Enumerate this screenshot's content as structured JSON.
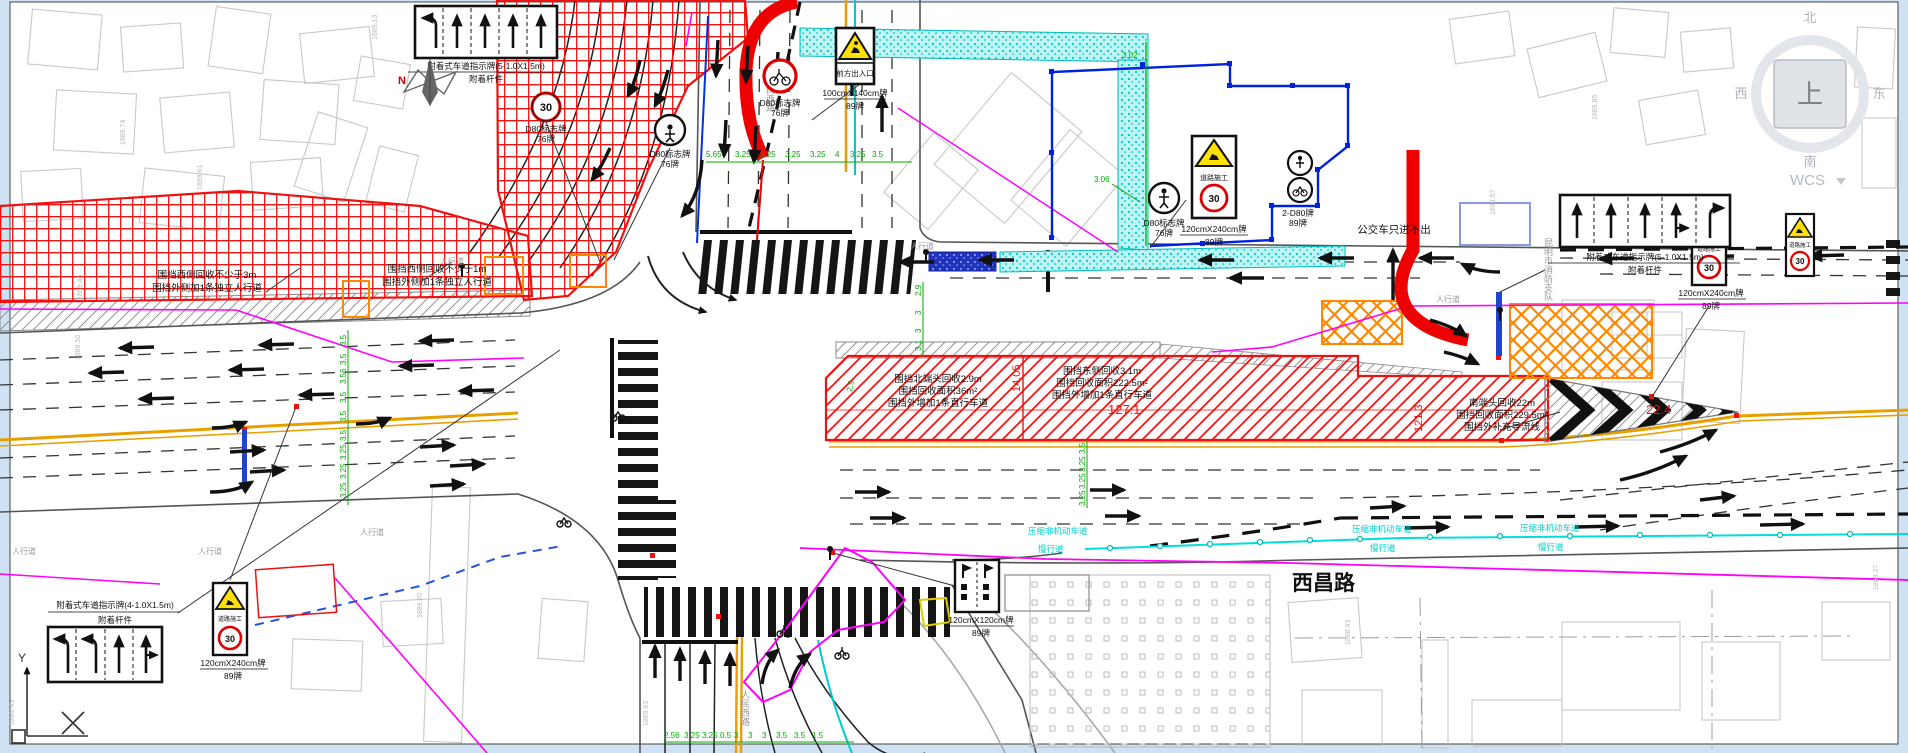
{
  "viewcube": {
    "up": "上",
    "north": "北",
    "south": "南",
    "west": "西",
    "east": "东",
    "wcs": "WCS"
  },
  "roads": {
    "renmin": "人民西路",
    "xichang": "西昌路",
    "fire": "昆明市消防支队",
    "sidewalk": "人行道",
    "bus_note": "公交车只进不出"
  },
  "signs": {
    "speed": "30",
    "work_plate": "道路施工",
    "entrance_plate": "前方出入口",
    "d80": "D80标志牌",
    "d80_count": "76牌",
    "d80x2": "2-D80牌",
    "c89": "89牌",
    "s100": "100cmX140cm牌",
    "s240": "120cmX240cm牌",
    "s120": "120cmX120cm牌",
    "north": "N"
  },
  "boards": {
    "b5": "附着式车道指示牌(5-1.0X1.5m)",
    "b4": "附着式车道指示牌(4-1.0X1.5m)",
    "pole": "附着杆件"
  },
  "zones": {
    "west_a1": "围挡西侧回收不少于3m",
    "west_a2": "围挡外侧加1条独立人行道",
    "west_b1": "围挡西侧回收不少于1m",
    "west_b2": "围挡外侧加1条独立人行道",
    "north1": "围挡北端头回收2.9m",
    "north2": "围挡回收面积36m²",
    "north3": "围挡外增加1条直行车道",
    "east1": "围挡东侧回收3.1m",
    "east2": "围挡回收面积222.5m²",
    "east3": "围挡外增加1条直行车道",
    "south1": "南端头回收22m",
    "south2": "围挡回收面积229.5m²",
    "south3": "围挡外补充导流线"
  },
  "bike": {
    "a": "压缩非机动车道",
    "b": "慢行道"
  },
  "dims": {
    "north_row": [
      "5.65",
      "3.25",
      "3.25",
      "3.25",
      "3.25",
      "4",
      "3.25",
      "3.5"
    ],
    "west_col": [
      "3.5",
      "3.5",
      "3.56",
      "3.5",
      "3.5",
      "3.5",
      "3.25",
      "3.25",
      "3.25"
    ],
    "mid_col": [
      "2.9",
      "3",
      "3",
      "3.1"
    ],
    "east_col": [
      "3.5",
      "3.25",
      "3.25",
      "3.25"
    ],
    "south_row": [
      "2.56",
      "3.25",
      "3.25",
      "0.5",
      "3",
      "3",
      "3",
      "3.5",
      "3.5",
      "1.5"
    ],
    "d302": "3.02",
    "d306": "3.06",
    "d29": "2.9",
    "red_a": "14.05",
    "red_b": "127.1",
    "red_c": "121.3",
    "red_d": "22.4"
  },
  "elev": [
    "1889.13",
    "1889.46",
    "1889.50",
    "1889.74",
    "1889.61",
    "1889.85",
    "1889.57",
    "1889.20",
    "1888.43",
    "1889.45",
    "1889.63",
    "1889.37"
  ],
  "colors": {
    "construction_red": "#ee1111",
    "hatch_orange": "#ff8800",
    "zone_cyan": "#00cccc",
    "line_magenta": "#ff00ff",
    "boundary_blue": "#0022dd",
    "dim_green": "#00aa00",
    "center_yellow": "#e8a000"
  }
}
